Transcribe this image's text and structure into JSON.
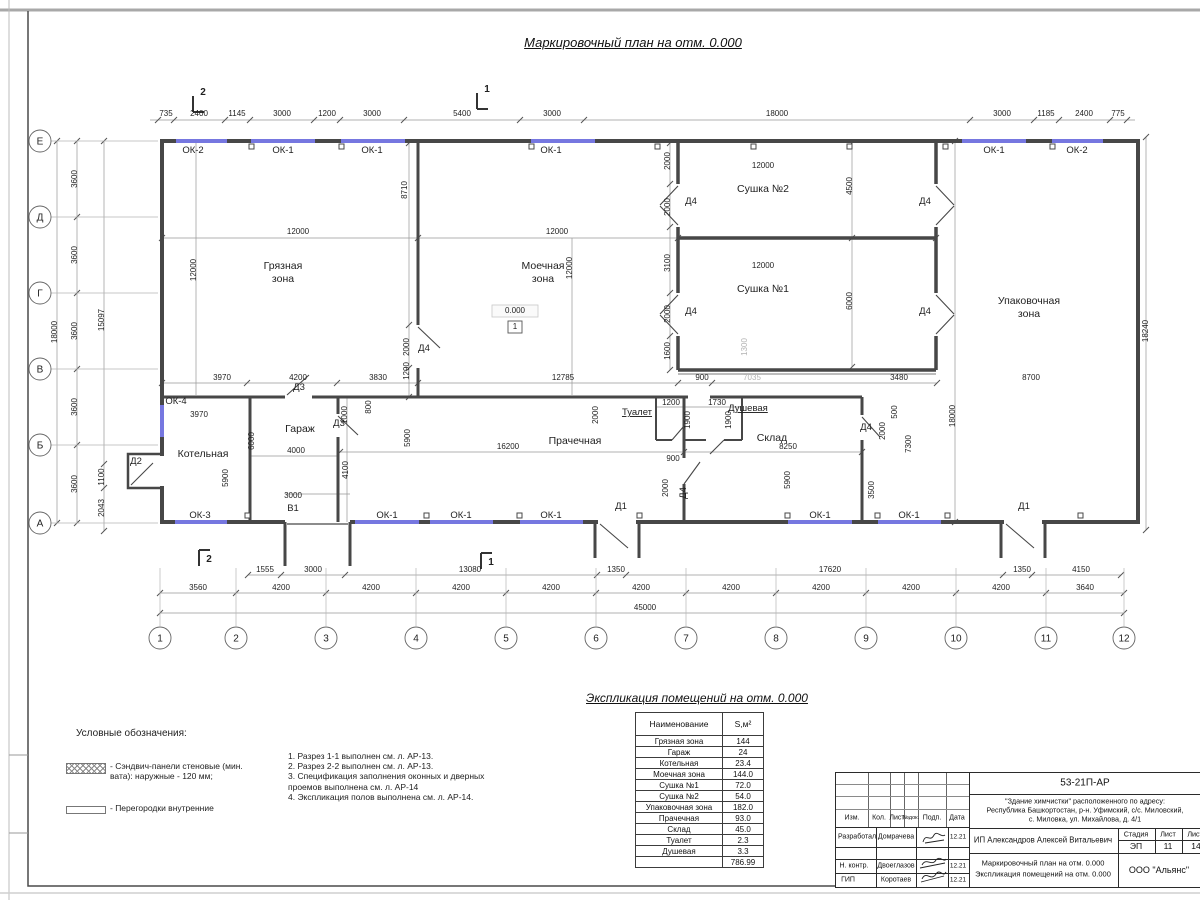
{
  "sheet": {
    "title": "Маркировочный план на отм. 0.000",
    "schedule_title": "Экспликация помещений на отм. 0.000"
  },
  "colors": {
    "window_blue": "#7677e0",
    "wall_grey": "#474747",
    "dim_grey": "#989898"
  },
  "plan": {
    "elevation_mark": "0.000",
    "elevation_node": "1",
    "axis_letters": [
      [
        "Е",
        141
      ],
      [
        "Д",
        217
      ],
      [
        "Г",
        293
      ],
      [
        "В",
        369
      ],
      [
        "Б",
        445
      ],
      [
        "А",
        523
      ]
    ],
    "axis_numbers": [
      [
        "1",
        160
      ],
      [
        "2",
        236
      ],
      [
        "3",
        326
      ],
      [
        "4",
        416
      ],
      [
        "5",
        506
      ],
      [
        "6",
        596
      ],
      [
        "7",
        686
      ],
      [
        "8",
        776
      ],
      [
        "9",
        866
      ],
      [
        "10",
        956
      ],
      [
        "11",
        1046
      ],
      [
        "12",
        1124
      ]
    ],
    "labels": [
      [
        "735",
        166,
        116
      ],
      [
        "2400",
        199,
        116
      ],
      [
        "1145",
        237,
        116
      ],
      [
        "3000",
        282,
        116
      ],
      [
        "1200",
        327,
        116
      ],
      [
        "3000",
        372,
        116
      ],
      [
        "5400",
        462,
        116
      ],
      [
        "3000",
        552,
        116
      ],
      [
        "18000",
        777,
        116
      ],
      [
        "3000",
        1002,
        116
      ],
      [
        "1185",
        1046,
        116
      ],
      [
        "2400",
        1084,
        116
      ],
      [
        "775",
        1118,
        116
      ],
      [
        "2",
        203,
        95,
        "s"
      ],
      [
        "1",
        487,
        92,
        "s"
      ],
      [
        "2",
        209,
        562,
        "s"
      ],
      [
        "1",
        491,
        565,
        "s"
      ],
      [
        "ОК-2",
        193,
        153,
        "t"
      ],
      [
        "ОК-1",
        283,
        153,
        "t"
      ],
      [
        "ОК-1",
        372,
        153,
        "t"
      ],
      [
        "ОК-1",
        551,
        153,
        "t"
      ],
      [
        "ОК-1",
        994,
        153,
        "t"
      ],
      [
        "ОК-2",
        1077,
        153,
        "t"
      ],
      [
        "ОК-3",
        200,
        518,
        "t"
      ],
      [
        "ОК-1",
        387,
        518,
        "t"
      ],
      [
        "ОК-1",
        461,
        518,
        "t"
      ],
      [
        "ОК-1",
        551,
        518,
        "t"
      ],
      [
        "ОК-1",
        820,
        518,
        "t"
      ],
      [
        "ОК-1",
        909,
        518,
        "t"
      ],
      [
        "ОК-4",
        176,
        404,
        "t"
      ],
      [
        "Грязная",
        283,
        269,
        "m"
      ],
      [
        "зона",
        283,
        282,
        "m"
      ],
      [
        "Моечная",
        543,
        269,
        "m"
      ],
      [
        "зона",
        543,
        282,
        "m"
      ],
      [
        "Сушка №2",
        763,
        192,
        "m"
      ],
      [
        "Сушка №1",
        763,
        292,
        "m"
      ],
      [
        "Упаковочная",
        1029,
        304,
        "m"
      ],
      [
        "зона",
        1029,
        317,
        "m"
      ],
      [
        "Котельная",
        203,
        457,
        "m"
      ],
      [
        "Гараж",
        300,
        432,
        "m"
      ],
      [
        "Прачечная",
        575,
        444,
        "m"
      ],
      [
        "Склад",
        772,
        441,
        "m"
      ],
      [
        "Туалет",
        637,
        415,
        "tu"
      ],
      [
        "Душевая",
        748,
        411,
        "tu"
      ],
      [
        "В1",
        293,
        511,
        "t"
      ],
      [
        "Д2",
        136,
        464,
        "t"
      ],
      [
        "Д3",
        299,
        390,
        "t"
      ],
      [
        "Д3",
        339,
        426,
        "t"
      ],
      [
        "Д4",
        424,
        351,
        "t"
      ],
      [
        "Д4",
        691,
        204,
        "t"
      ],
      [
        "Д4",
        925,
        204,
        "t"
      ],
      [
        "Д4",
        691,
        314,
        "t"
      ],
      [
        "Д4",
        925,
        314,
        "t"
      ],
      [
        "Д4",
        866,
        430,
        "t"
      ],
      [
        "Д4",
        686,
        493,
        "tr"
      ],
      [
        "Д1",
        621,
        509,
        "t"
      ],
      [
        "Д1",
        1024,
        509,
        "t"
      ],
      [
        "0.000",
        515,
        313
      ],
      [
        "1",
        515,
        329
      ],
      [
        "3600",
        77,
        179,
        "r"
      ],
      [
        "3600",
        77,
        255,
        "r"
      ],
      [
        "3600",
        77,
        331,
        "r"
      ],
      [
        "3600",
        77,
        407,
        "r"
      ],
      [
        "3600",
        77,
        484,
        "r"
      ],
      [
        "18000",
        57,
        332,
        "r"
      ],
      [
        "15097",
        104,
        320,
        "r"
      ],
      [
        "1100",
        104,
        477,
        "r"
      ],
      [
        "2043",
        104,
        508,
        "r"
      ],
      [
        "12000",
        298,
        234
      ],
      [
        "12000",
        196,
        270,
        "r"
      ],
      [
        "8710",
        407,
        190,
        "r"
      ],
      [
        "2000",
        409,
        347,
        "r"
      ],
      [
        "1290",
        409,
        371,
        "r"
      ],
      [
        "3970",
        222,
        380
      ],
      [
        "4200",
        298,
        380
      ],
      [
        "3830",
        378,
        380
      ],
      [
        "12000",
        557,
        234
      ],
      [
        "12000",
        572,
        268,
        "r"
      ],
      [
        "12785",
        563,
        380
      ],
      [
        "2000",
        670,
        161,
        "r"
      ],
      [
        "2000",
        670,
        207,
        "r"
      ],
      [
        "3100",
        670,
        263,
        "r"
      ],
      [
        "2000",
        670,
        314,
        "r"
      ],
      [
        "1600",
        670,
        351,
        "r"
      ],
      [
        "12000",
        763,
        168
      ],
      [
        "4500",
        852,
        186,
        "r"
      ],
      [
        "12000",
        763,
        268
      ],
      [
        "6000",
        852,
        301,
        "r"
      ],
      [
        "1300",
        747,
        347,
        "rg"
      ],
      [
        "900",
        702,
        380
      ],
      [
        "7035",
        752,
        380,
        "g"
      ],
      [
        "3480",
        899,
        380
      ],
      [
        "8700",
        1031,
        380
      ],
      [
        "18000",
        955,
        416,
        "r"
      ],
      [
        "18240",
        1148,
        331,
        "r"
      ],
      [
        "1200",
        671,
        405
      ],
      [
        "1730",
        717,
        405
      ],
      [
        "900",
        673,
        461
      ],
      [
        "2000",
        598,
        415,
        "r"
      ],
      [
        "1900",
        690,
        420,
        "r"
      ],
      [
        "1900",
        731,
        420,
        "r"
      ],
      [
        "16200",
        508,
        449
      ],
      [
        "8250",
        788,
        449
      ],
      [
        "2000",
        668,
        488,
        "r"
      ],
      [
        "5900",
        790,
        480,
        "r"
      ],
      [
        "3500",
        874,
        490,
        "r"
      ],
      [
        "2000",
        885,
        431,
        "r"
      ],
      [
        "500",
        897,
        412,
        "r"
      ],
      [
        "7300",
        911,
        444,
        "r"
      ],
      [
        "5900",
        410,
        438,
        "r"
      ],
      [
        "6000",
        254,
        441,
        "r"
      ],
      [
        "4000",
        296,
        453
      ],
      [
        "3000",
        293,
        498
      ],
      [
        "1000",
        347,
        415,
        "r"
      ],
      [
        "800",
        371,
        407,
        "r"
      ],
      [
        "4100",
        348,
        470,
        "r"
      ],
      [
        "5900",
        228,
        478,
        "r"
      ],
      [
        "3970",
        199,
        417
      ],
      [
        "1555",
        265,
        572
      ],
      [
        "3000",
        313,
        572
      ],
      [
        "13080",
        470,
        572
      ],
      [
        "1350",
        616,
        572
      ],
      [
        "17620",
        830,
        572
      ],
      [
        "1350",
        1022,
        572
      ],
      [
        "4150",
        1081,
        572
      ],
      [
        "3560",
        198,
        590
      ],
      [
        "4200",
        281,
        590
      ],
      [
        "4200",
        371,
        590
      ],
      [
        "4200",
        461,
        590
      ],
      [
        "4200",
        551,
        590
      ],
      [
        "4200",
        641,
        590
      ],
      [
        "4200",
        731,
        590
      ],
      [
        "4200",
        821,
        590
      ],
      [
        "4200",
        911,
        590
      ],
      [
        "4200",
        1001,
        590
      ],
      [
        "3640",
        1085,
        590
      ],
      [
        "45000",
        645,
        610
      ]
    ]
  },
  "legend": {
    "heading": "Условные обозначения:",
    "items": [
      {
        "swatch": "hatch",
        "label": "- Сэндвич-панели стеновые (мин. вата): наружные - 120 мм;"
      },
      {
        "swatch": "wline",
        "label": "- Перегородки внутренние"
      }
    ]
  },
  "notes": [
    "1. Разрез 1-1 выполнен см. л. АР-13.",
    "2. Разрез 2-2 выполнен см. л. АР-13.",
    "3. Спецификация заполнения оконных и дверных проемов выполнена см. л. АР-14",
    "4. Экспликация полов выполнена см. л. АР-14."
  ],
  "schedule": {
    "headers": [
      "Наименование",
      "S,м²"
    ],
    "rows": [
      [
        "Грязная зона",
        "144"
      ],
      [
        "Гараж",
        "24"
      ],
      [
        "Котельная",
        "23.4"
      ],
      [
        "Моечная зона",
        "144.0"
      ],
      [
        "Сушка №1",
        "72.0"
      ],
      [
        "Сушка №2",
        "54.0"
      ],
      [
        "Упаковочная зона",
        "182.0"
      ],
      [
        "Прачечная",
        "93.0"
      ],
      [
        "Склад",
        "45.0"
      ],
      [
        "Туалет",
        "2.3"
      ],
      [
        "Душевая",
        "3.3"
      ]
    ],
    "total": "786.99"
  },
  "titleblock": {
    "code": "53-21П-АР",
    "address": [
      "\"Здание химчистки\" расположенного по адресу:",
      "Республика Башкортостан, р-н. Уфимский, с/с. Миловский,",
      "с. Миловка, ул. Михайлова, д. 4/1"
    ],
    "cols": [
      "Изм.",
      "Кол.",
      "Лист",
      "№док.",
      "Подп.",
      "Дата"
    ],
    "rows": [
      {
        "role": "Разработал",
        "name": "Домрачева",
        "date": "12.21"
      },
      {
        "role": "Н. контр.",
        "name": "Двоеглазов",
        "date": "12.21"
      },
      {
        "role": "ГИП",
        "name": "Коротаев",
        "date": "12.21"
      }
    ],
    "client": "ИП Александров Алексей Витальевич",
    "stage_label": "Стадия",
    "sheet_label": "Лист",
    "sheets_label": "Листов",
    "stage": "ЭП",
    "sheet": "11",
    "sheets": "14",
    "doc_title_lines": [
      "Маркировочный план на отм. 0.000",
      "Экспликация помещений на отм. 0.000"
    ],
    "company": "ООО \"Альянс\""
  }
}
